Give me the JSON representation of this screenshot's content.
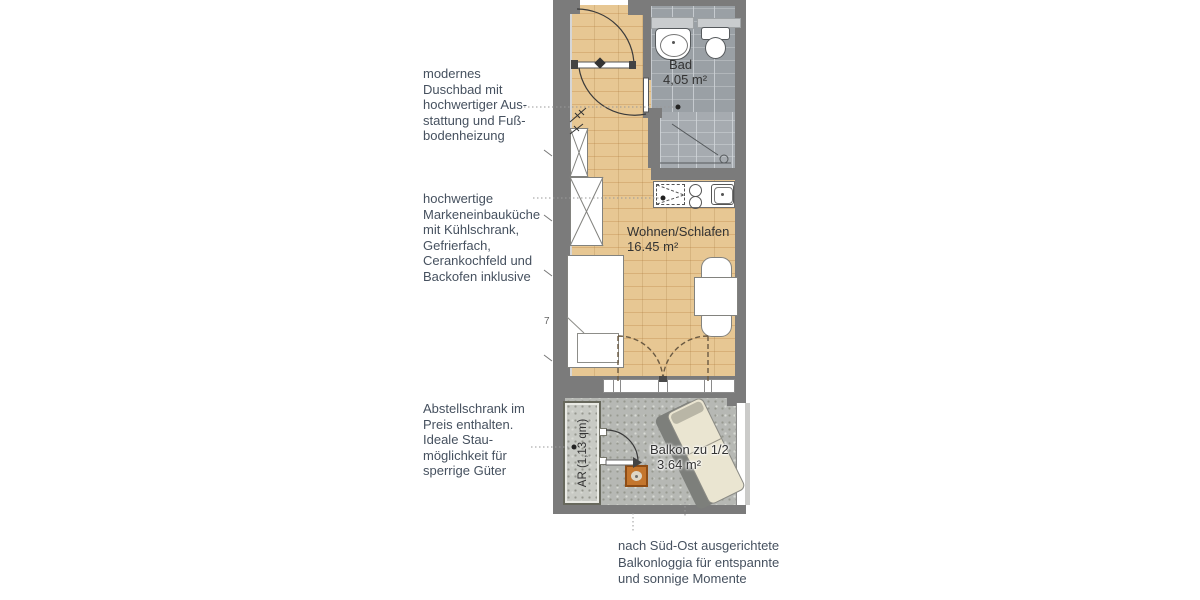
{
  "annotations": {
    "bathroom": {
      "lines": [
        "modernes",
        "Duschbad mit",
        "hochwertiger Aus-",
        "stattung und Fuß-",
        "bodenheizung"
      ]
    },
    "kitchen": {
      "lines": [
        "hochwertige",
        "Markeneinbauküche",
        "mit Kühlschrank,",
        "Gefrierfach,",
        "Cerankochfeld und",
        "Backofen inklusive"
      ]
    },
    "storage": {
      "lines": [
        "Abstellschrank im",
        "Preis enthalten.",
        "Ideale Stau-",
        "möglichkeit für",
        "sperrige Güter"
      ]
    },
    "balcony": {
      "lines": [
        "nach Süd-Ost ausgerichtete",
        "Balkonloggia für entspannte",
        "und sonnige Momente"
      ]
    }
  },
  "plan": {
    "rooms": {
      "bad": {
        "name": "Bad",
        "area": "4,05 m²"
      },
      "wohnen": {
        "name": "Wohnen/Schlafen",
        "area": "16.45 m²"
      },
      "balkon": {
        "name": "Balkon zu 1/2",
        "area": "3.64 m²"
      },
      "abstellraum": {
        "label": "AR (1,13 qm)"
      }
    },
    "dimension_fragment": "7",
    "colors": {
      "wall": "#7b7b7b",
      "wood_floor": "#e3c28e",
      "bath_tile": "#9ba0a5",
      "balcony_concrete": "#b6b8b4",
      "accent_orange": "#c4762e",
      "annotation_text": "#46515f"
    }
  }
}
